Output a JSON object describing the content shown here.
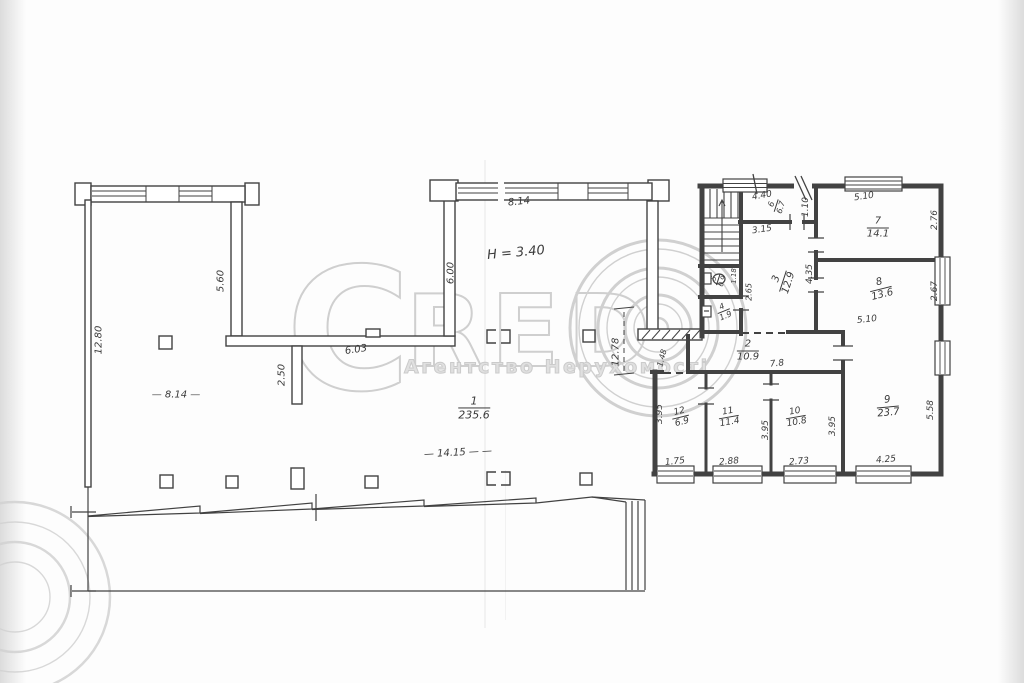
{
  "watermark": {
    "letter_c": "C",
    "letters_red": "RED",
    "subtitle": "Агентство Нерухомості"
  },
  "plan": {
    "rooms": [
      {
        "number": "1",
        "area": "235.6",
        "x": 474,
        "y": 408,
        "rot": 0,
        "size": 11
      },
      {
        "number": "2",
        "area": "10.9",
        "x": 748,
        "y": 351,
        "rot": 0,
        "size": 10
      },
      {
        "number": "3",
        "area": "12.9",
        "x": 783,
        "y": 281,
        "rot": -72,
        "size": 10
      },
      {
        "number": "4",
        "area": "1.9",
        "x": 724,
        "y": 312,
        "rot": -22,
        "size": 8
      },
      {
        "number": "5",
        "area": "0.9",
        "x": 719,
        "y": 280,
        "rot": -72,
        "size": 7
      },
      {
        "number": "6",
        "area": "6.7",
        "x": 777,
        "y": 206,
        "rot": -72,
        "size": 8
      },
      {
        "number": "7",
        "area": "14.1",
        "x": 878,
        "y": 228,
        "rot": 0,
        "size": 10
      },
      {
        "number": "8",
        "area": "13.6",
        "x": 881,
        "y": 289,
        "rot": -14,
        "size": 10
      },
      {
        "number": "9",
        "area": "23.7",
        "x": 888,
        "y": 407,
        "rot": -5,
        "size": 10
      },
      {
        "number": "10",
        "area": "10.8",
        "x": 796,
        "y": 418,
        "rot": -10,
        "size": 9
      },
      {
        "number": "11",
        "area": "11.4",
        "x": 729,
        "y": 418,
        "rot": -10,
        "size": 9
      },
      {
        "number": "12",
        "area": "6.9",
        "x": 681,
        "y": 418,
        "rot": -14,
        "size": 9
      }
    ],
    "dimensions": [
      {
        "text": "12.80",
        "x": 99,
        "y": 340,
        "rot": -90
      },
      {
        "text": "5.60",
        "x": 221,
        "y": 281,
        "rot": -90
      },
      {
        "text": "2.50",
        "x": 282,
        "y": 375,
        "rot": -90
      },
      {
        "text": "6.03",
        "x": 356,
        "y": 350,
        "rot": -8
      },
      {
        "text": "6.00",
        "x": 451,
        "y": 273,
        "rot": -90
      },
      {
        "text": "8.14",
        "x": 519,
        "y": 202,
        "rot": -6
      },
      {
        "text": "— 8.14 —",
        "x": 176,
        "y": 395,
        "rot": 0
      },
      {
        "text": "Н = 3.40",
        "x": 516,
        "y": 253,
        "rot": -5,
        "size": 13
      },
      {
        "text": "— 14.15 — —",
        "x": 458,
        "y": 453,
        "rot": -3
      },
      {
        "text": "12.78",
        "x": 616,
        "y": 352,
        "rot": -90
      },
      {
        "text": "4.40",
        "x": 762,
        "y": 196,
        "rot": -10,
        "size": 9
      },
      {
        "text": "1.10",
        "x": 806,
        "y": 207,
        "rot": -90,
        "size": 9
      },
      {
        "text": "3.15",
        "x": 762,
        "y": 230,
        "rot": -8,
        "size": 9
      },
      {
        "text": "5.10",
        "x": 864,
        "y": 197,
        "rot": -8,
        "size": 9
      },
      {
        "text": "2.76",
        "x": 935,
        "y": 220,
        "rot": -90,
        "size": 9
      },
      {
        "text": "2.67",
        "x": 935,
        "y": 291,
        "rot": -90,
        "size": 9
      },
      {
        "text": "5.10",
        "x": 867,
        "y": 320,
        "rot": -6,
        "size": 9
      },
      {
        "text": "4.35",
        "x": 810,
        "y": 274,
        "rot": -90,
        "size": 9
      },
      {
        "text": "1.18",
        "x": 734,
        "y": 276,
        "rot": -90,
        "size": 7
      },
      {
        "text": "2.65",
        "x": 749,
        "y": 292,
        "rot": -90,
        "size": 8
      },
      {
        "text": "1.48",
        "x": 662,
        "y": 358,
        "rot": -75,
        "size": 8
      },
      {
        "text": "7.8",
        "x": 777,
        "y": 364,
        "rot": -6,
        "size": 9
      },
      {
        "text": "3.95",
        "x": 660,
        "y": 414,
        "rot": -90,
        "size": 9
      },
      {
        "text": "1.75",
        "x": 675,
        "y": 462,
        "rot": -6,
        "size": 9
      },
      {
        "text": "2.88",
        "x": 729,
        "y": 462,
        "rot": -5,
        "size": 9
      },
      {
        "text": "3.95",
        "x": 766,
        "y": 430,
        "rot": -90,
        "size": 9
      },
      {
        "text": "2.73",
        "x": 799,
        "y": 462,
        "rot": -5,
        "size": 9
      },
      {
        "text": "3.95",
        "x": 833,
        "y": 426,
        "rot": -90,
        "size": 9
      },
      {
        "text": "4.25",
        "x": 886,
        "y": 460,
        "rot": -5,
        "size": 9
      },
      {
        "text": "5.58",
        "x": 931,
        "y": 410,
        "rot": -90,
        "size": 9
      }
    ]
  }
}
